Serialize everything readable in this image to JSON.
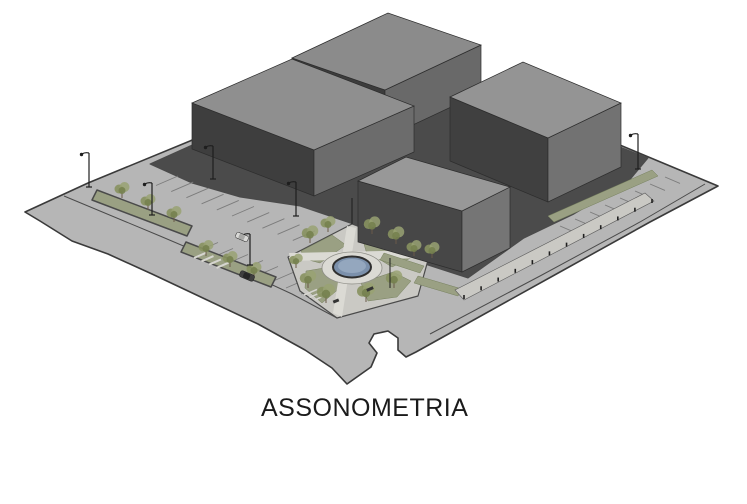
{
  "title": {
    "text": "ASSONOMETRIA"
  },
  "canvas": {
    "width": 747,
    "height": 504,
    "background": "#ffffff"
  },
  "palette": {
    "road": "#b6b6b6",
    "edge": "#3a3a3a",
    "platform": "#4b4b4b",
    "curb": "#4a4a4a",
    "sidewalk": "#cac9c4",
    "walk_edge": "#5a5a5a",
    "plaza_circle": "#dbdad4",
    "plaza_circle_edge": "#8d8d86",
    "lawn": "#9aa083",
    "lawn_edge": "#76805e",
    "water": "#7b90ab",
    "water_light": "#94a7be",
    "fountain_rim": "#2f2f2f",
    "stripe": "#7c7c7c",
    "crosswalk": "#d6d5d0",
    "bollard": "#1f1f1f",
    "pole": "#1e1e1e",
    "trunk": "#6a5a48",
    "foliage": [
      "#87915f",
      "#99a273",
      "#76814f"
    ],
    "building_stroke": "#2d2d2d",
    "bench": "#333333"
  },
  "scene": {
    "site": {
      "outline": [
        [
          25,
          212
        ],
        [
          40,
          221
        ],
        [
          72,
          241
        ],
        [
          108,
          254
        ],
        [
          152,
          274
        ],
        [
          205,
          299
        ],
        [
          258,
          324
        ],
        [
          305,
          350
        ],
        [
          332,
          368
        ],
        [
          347,
          384
        ],
        [
          371,
          367
        ],
        [
          377,
          353
        ],
        [
          369,
          343
        ],
        [
          374,
          334
        ],
        [
          388,
          331
        ],
        [
          398,
          338
        ],
        [
          398,
          350
        ],
        [
          406,
          357
        ],
        [
          416,
          352
        ],
        [
          470,
          322
        ],
        [
          560,
          272
        ],
        [
          650,
          222
        ],
        [
          718,
          186
        ],
        [
          560,
          120
        ],
        [
          390,
          57
        ],
        [
          292,
          95
        ],
        [
          190,
          141
        ],
        [
          88,
          183
        ]
      ],
      "platform": [
        [
          150,
          164
        ],
        [
          390,
          56
        ],
        [
          648,
          158
        ],
        [
          628,
          182
        ],
        [
          574,
          214
        ],
        [
          524,
          238
        ],
        [
          468,
          278
        ],
        [
          400,
          256
        ],
        [
          362,
          227
        ],
        [
          300,
          206
        ],
        [
          240,
          197
        ],
        [
          192,
          183
        ]
      ],
      "curbs": [
        [
          [
            64,
            196
          ],
          [
            160,
            236
          ],
          [
            240,
            270
          ],
          [
            292,
            294
          ],
          [
            322,
            310
          ],
          [
            337,
            318
          ]
        ],
        [
          [
            430,
            334
          ],
          [
            540,
            276
          ],
          [
            640,
            222
          ],
          [
            705,
            184
          ]
        ]
      ]
    },
    "parking": {
      "stripe_bands": [
        {
          "name": "parking-stalls-upper",
          "start": [
            178,
            176
          ],
          "step": [
            15.2,
            6.1
          ],
          "count": 15,
          "vec": [
            -22,
            9.5
          ]
        },
        {
          "name": "parking-stalls-lower",
          "start": [
            196,
            252
          ],
          "step": [
            15,
            6
          ],
          "count": 8,
          "vec": [
            22,
            -9.5
          ]
        },
        {
          "name": "street-stalls-east",
          "start": [
            560,
            226
          ],
          "step": [
            15,
            -7
          ],
          "count": 8,
          "vec": [
            15,
            6.4
          ]
        }
      ],
      "islands": [
        {
          "name": "parking-island-1",
          "points": [
            [
              97,
              190
            ],
            [
              192,
              226
            ],
            [
              187,
              236
            ],
            [
              92,
              200
            ]
          ]
        },
        {
          "name": "parking-island-2",
          "points": [
            [
              186,
              242
            ],
            [
              276,
              277
            ],
            [
              271,
              287
            ],
            [
              181,
              252
            ]
          ]
        }
      ]
    },
    "plaza": {
      "base": [
        [
          288,
          257
        ],
        [
          352,
          224
        ],
        [
          430,
          253
        ],
        [
          418,
          296
        ],
        [
          337,
          318
        ],
        [
          300,
          291
        ]
      ],
      "lawns": [
        [
          [
            301,
            251
          ],
          [
            332,
            235
          ],
          [
            346,
            245
          ],
          [
            320,
            263
          ],
          [
            305,
            259
          ]
        ],
        [
          [
            362,
            237
          ],
          [
            400,
            241
          ],
          [
            417,
            255
          ],
          [
            392,
            267
          ],
          [
            366,
            251
          ]
        ],
        [
          [
            306,
            271
          ],
          [
            330,
            267
          ],
          [
            341,
            287
          ],
          [
            322,
            303
          ],
          [
            305,
            288
          ]
        ],
        [
          [
            361,
            283
          ],
          [
            393,
            272
          ],
          [
            411,
            281
          ],
          [
            397,
            297
          ],
          [
            368,
            301
          ]
        ]
      ],
      "paths": [
        [
          [
            347,
            226
          ],
          [
            356,
            228
          ],
          [
            342,
            317
          ],
          [
            333,
            313
          ]
        ],
        [
          [
            289,
            253
          ],
          [
            290,
            261
          ],
          [
            428,
            258
          ],
          [
            427,
            250
          ]
        ]
      ],
      "circle": {
        "cx": 352,
        "cy": 268,
        "rx": 30,
        "ry": 16
      },
      "fountain": {
        "cx": 352,
        "cy": 267,
        "rx": 19,
        "ry": 10.5
      },
      "green_strips": [
        [
          [
            384,
            253
          ],
          [
            424,
            266
          ],
          [
            420,
            273
          ],
          [
            380,
            260
          ]
        ],
        [
          [
            418,
            276
          ],
          [
            462,
            289
          ],
          [
            458,
            296
          ],
          [
            414,
            283
          ]
        ],
        [
          [
            548,
            216
          ],
          [
            652,
            170
          ],
          [
            658,
            176
          ],
          [
            554,
            222
          ]
        ]
      ],
      "walkway": [
        [
          455,
          290
        ],
        [
          645,
          193
        ],
        [
          654,
          201
        ],
        [
          464,
          300
        ]
      ],
      "bollards": {
        "from": [
          464,
          299
        ],
        "to": [
          652,
          203
        ],
        "count": 12
      }
    },
    "buildings": [
      {
        "name": "building-back",
        "top": [
          [
            292,
            58
          ],
          [
            388,
            13
          ],
          [
            481,
            45
          ],
          [
            385,
            90
          ]
        ],
        "h": 48,
        "top_fill": "#8b8b8b",
        "left_fill": "#3c3c3c",
        "right_fill": "#696969"
      },
      {
        "name": "building-right",
        "top": [
          [
            450,
            97
          ],
          [
            523,
            62
          ],
          [
            621,
            103
          ],
          [
            548,
            138
          ]
        ],
        "h": 64,
        "top_fill": "#949494",
        "left_fill": "#404040",
        "right_fill": "#727272"
      },
      {
        "name": "building-left",
        "top": [
          [
            192,
            103
          ],
          [
            292,
            59
          ],
          [
            414,
            106
          ],
          [
            314,
            150
          ]
        ],
        "h": 46,
        "top_fill": "#8f8f8f",
        "left_fill": "#3e3e3e",
        "right_fill": "#6c6c6c"
      },
      {
        "name": "building-front",
        "top": [
          [
            358,
            181
          ],
          [
            406,
            157
          ],
          [
            510,
            187
          ],
          [
            462,
            211
          ]
        ],
        "h": 61,
        "top_fill": "#989898",
        "left_fill": "#474747",
        "right_fill": "#757575"
      }
    ],
    "trees": [
      [
        122,
        198,
        1
      ],
      [
        148,
        210,
        1
      ],
      [
        174,
        222,
        1
      ],
      [
        206,
        256,
        1
      ],
      [
        230,
        267,
        1
      ],
      [
        254,
        278,
        1
      ],
      [
        310,
        243,
        1.1
      ],
      [
        328,
        232,
        1
      ],
      [
        372,
        234,
        1.1
      ],
      [
        396,
        244,
        1.1
      ],
      [
        414,
        256,
        1
      ],
      [
        296,
        268,
        0.9
      ],
      [
        308,
        288,
        1.1
      ],
      [
        326,
        303,
        1.2
      ],
      [
        366,
        302,
        1.2
      ],
      [
        394,
        288,
        1.1
      ],
      [
        432,
        258,
        1
      ]
    ],
    "lamps": [
      [
        89,
        187,
        34
      ],
      [
        152,
        215,
        32
      ],
      [
        213,
        179,
        33
      ],
      [
        296,
        216,
        34
      ],
      [
        250,
        265,
        31
      ],
      [
        638,
        169,
        35
      ]
    ],
    "poles": [
      [
        352,
        224,
        26
      ],
      [
        390,
        288,
        30
      ]
    ],
    "benches": [
      {
        "x": 370,
        "y": 289,
        "w": 7,
        "h": 3,
        "angle": -23
      },
      {
        "x": 336,
        "y": 301,
        "w": 6,
        "h": 3,
        "angle": -23
      }
    ],
    "cars": [
      {
        "name": "car-on-road",
        "cx": 247,
        "cy": 276,
        "w": 15,
        "h": 6.5,
        "angle": 23,
        "body": "#3f3f3f",
        "roof": "#262626"
      },
      {
        "name": "car-parked",
        "cx": 242,
        "cy": 237,
        "w": 13,
        "h": 6,
        "angle": 23,
        "body": "#d9d9d7",
        "roof": "#a8a8a6"
      }
    ],
    "road_marks": [
      {
        "name": "crosswalk-front-road",
        "start": [
          194,
          258
        ],
        "step": [
          7.5,
          3.3
        ],
        "count": 4,
        "vec": [
          12,
          -5.2
        ],
        "w": 2
      },
      {
        "name": "plaza-steps",
        "start": [
          304,
          295
        ],
        "step": [
          5.5,
          2.4
        ],
        "count": 3,
        "vec": [
          13,
          -5.6
        ],
        "w": 1.5
      }
    ]
  }
}
